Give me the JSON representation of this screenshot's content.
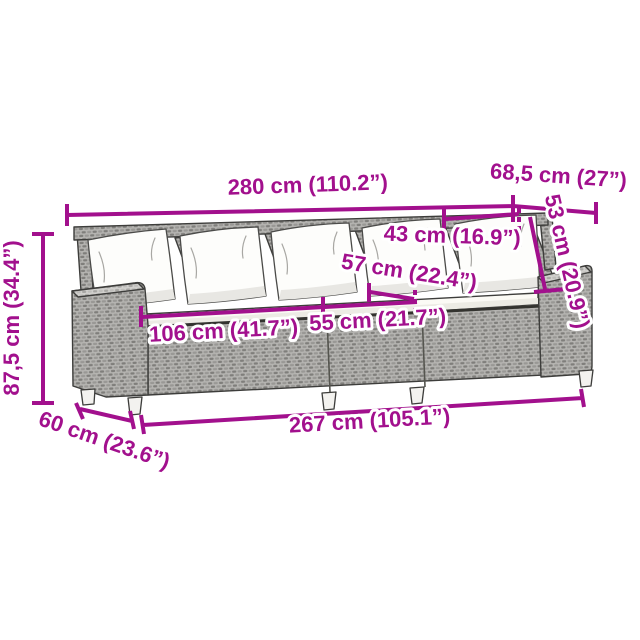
{
  "diagram": {
    "kind": "product-dimension-diagram",
    "accent_color": "#A2108D",
    "wicker_color": "#b5b4b1",
    "dimensions": {
      "overall_width": {
        "label": "280 cm (110.2”)"
      },
      "overall_depth": {
        "label": "68,5 cm (27”)"
      },
      "back_height": {
        "label": "53 cm (20.9”)"
      },
      "back_cushion_width": {
        "label": "43 cm (16.9”)"
      },
      "seat_depth": {
        "label": "57 cm (22.4”)"
      },
      "end_seat_width": {
        "label": "106 cm (41.7”)"
      },
      "middle_seat_width": {
        "label": "55 cm (21.7”)"
      },
      "overall_height": {
        "label": "87,5 cm (34.4”)"
      },
      "base_depth": {
        "label": "60 cm (23.6”)"
      },
      "base_width": {
        "label": "267 cm (105.1”)"
      }
    }
  }
}
